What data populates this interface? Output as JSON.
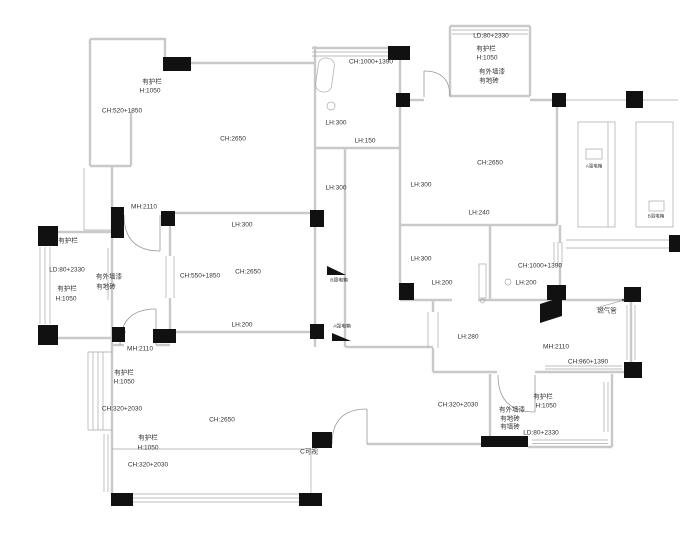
{
  "plan": {
    "background": "#ffffff",
    "colors": {
      "wall": "#c9c9c9",
      "thin_line": "#a9a9a9",
      "column": "#111111",
      "door_arc": "#9a9a9a",
      "label_text": "#333333"
    },
    "labels": [
      {
        "t": "有护栏",
        "x": 152,
        "y": 82
      },
      {
        "t": "H:1050",
        "x": 150,
        "y": 91
      },
      {
        "t": "CH:520+1850",
        "x": 122,
        "y": 111
      },
      {
        "t": "CH:2650",
        "x": 233,
        "y": 139
      },
      {
        "t": "MH:2110",
        "x": 144,
        "y": 207
      },
      {
        "t": "CH:1000+1390",
        "x": 371,
        "y": 62
      },
      {
        "t": "LH:300",
        "x": 336,
        "y": 123
      },
      {
        "t": "LH:150",
        "x": 365,
        "y": 141
      },
      {
        "t": "LH:300",
        "x": 336,
        "y": 188
      },
      {
        "t": "LH:300",
        "x": 421,
        "y": 185
      },
      {
        "t": "LD:80+2330",
        "x": 491,
        "y": 36
      },
      {
        "t": "有护栏",
        "x": 486,
        "y": 49
      },
      {
        "t": "H:1050",
        "x": 487,
        "y": 58
      },
      {
        "t": "有外墙漆",
        "x": 492,
        "y": 72
      },
      {
        "t": "有地砖",
        "x": 489,
        "y": 81
      },
      {
        "t": "CH:2650",
        "x": 490,
        "y": 163
      },
      {
        "t": "LH:240",
        "x": 479,
        "y": 213
      },
      {
        "t": "有护栏",
        "x": 68,
        "y": 241
      },
      {
        "t": "LD:80+2330",
        "x": 67,
        "y": 270
      },
      {
        "t": "有外墙漆",
        "x": 109,
        "y": 277
      },
      {
        "t": "有地砖",
        "x": 106,
        "y": 287
      },
      {
        "t": "有护栏",
        "x": 67,
        "y": 289
      },
      {
        "t": "H:1050",
        "x": 66,
        "y": 299
      },
      {
        "t": "CH:550+1850",
        "x": 200,
        "y": 276
      },
      {
        "t": "CH:2650",
        "x": 248,
        "y": 272
      },
      {
        "t": "LH:300",
        "x": 242,
        "y": 225
      },
      {
        "t": "LH:200",
        "x": 242,
        "y": 325
      },
      {
        "t": "MH:2110",
        "x": 140,
        "y": 349
      },
      {
        "t": "B弱电箱",
        "x": 339,
        "y": 281,
        "size": 4.8
      },
      {
        "t": "A强电箱",
        "x": 342,
        "y": 327,
        "size": 4.8
      },
      {
        "t": "LH:300",
        "x": 421,
        "y": 259
      },
      {
        "t": "LH:200",
        "x": 442,
        "y": 283
      },
      {
        "t": "CH:1000+1390",
        "x": 540,
        "y": 266
      },
      {
        "t": "LH:200",
        "x": 526,
        "y": 283
      },
      {
        "t": "燃气管",
        "x": 607,
        "y": 311
      },
      {
        "t": "MH:2110",
        "x": 556,
        "y": 347
      },
      {
        "t": "CH:960+1390",
        "x": 588,
        "y": 362
      },
      {
        "t": "LH:280",
        "x": 468,
        "y": 337
      },
      {
        "t": "有护栏",
        "x": 124,
        "y": 373
      },
      {
        "t": "H:1050",
        "x": 124,
        "y": 382
      },
      {
        "t": "CH:320+2030",
        "x": 122,
        "y": 409
      },
      {
        "t": "CH:2650",
        "x": 222,
        "y": 420
      },
      {
        "t": "有护栏",
        "x": 148,
        "y": 438
      },
      {
        "t": "H:1050",
        "x": 148,
        "y": 448
      },
      {
        "t": "CH:320+2030",
        "x": 148,
        "y": 465
      },
      {
        "t": "C可视",
        "x": 309,
        "y": 452
      },
      {
        "t": "CH:320+2030",
        "x": 458,
        "y": 405
      },
      {
        "t": "有外墙漆",
        "x": 512,
        "y": 410
      },
      {
        "t": "有地砖",
        "x": 510,
        "y": 419
      },
      {
        "t": "有墙砖",
        "x": 510,
        "y": 427
      },
      {
        "t": "有护栏",
        "x": 543,
        "y": 397
      },
      {
        "t": "H:1050",
        "x": 546,
        "y": 406
      },
      {
        "t": "LD:80+2330",
        "x": 541,
        "y": 433
      },
      {
        "t": "A强电箱",
        "x": 594,
        "y": 166,
        "size": 4.5
      },
      {
        "t": "B弱电箱",
        "x": 656,
        "y": 216,
        "size": 4.5
      }
    ]
  }
}
